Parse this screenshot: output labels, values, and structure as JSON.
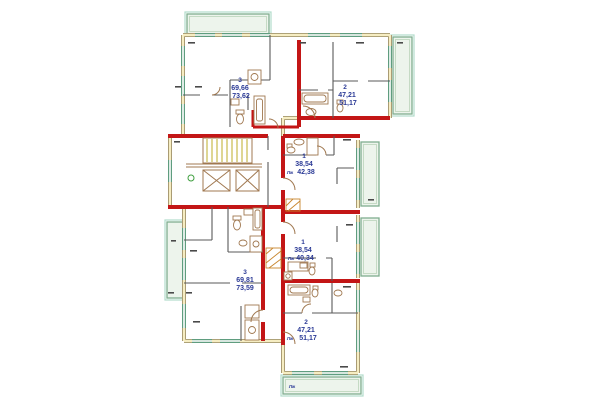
{
  "plan": {
    "colors": {
      "wall_red": "#c31616",
      "wall_tan": "#978860",
      "wall_fill": "#f6edc2",
      "window_green": "#5f9d7f",
      "balcony_green": "#7fae8f",
      "teal_accent": "#b2dccb",
      "label_blue": "#2b3a96",
      "fixture_tan": "#a07850",
      "stair_yellow": "#c9ba4e"
    },
    "apartments": [
      {
        "name": "top-left",
        "rooms": "3",
        "area_living": "69,66",
        "area_total": "73,62",
        "loggia": ""
      },
      {
        "name": "top-right",
        "rooms": "2",
        "area_living": "47,21",
        "area_total": "51,17",
        "loggia": ""
      },
      {
        "name": "mid-right",
        "rooms": "1",
        "area_living": "38,54",
        "area_total": "42,38",
        "loggia": "Лж"
      },
      {
        "name": "lower-mid",
        "rooms": "1",
        "area_living": "38,54",
        "area_total": "40,34",
        "loggia": "Лж"
      },
      {
        "name": "lower-left",
        "rooms": "3",
        "area_living": "69,81",
        "area_total": "73,59",
        "loggia": ""
      },
      {
        "name": "bottom-right",
        "rooms": "2",
        "area_living": "47,21",
        "area_total": "51,17",
        "loggia": "Лж"
      }
    ],
    "balcony_label": "Лж"
  }
}
